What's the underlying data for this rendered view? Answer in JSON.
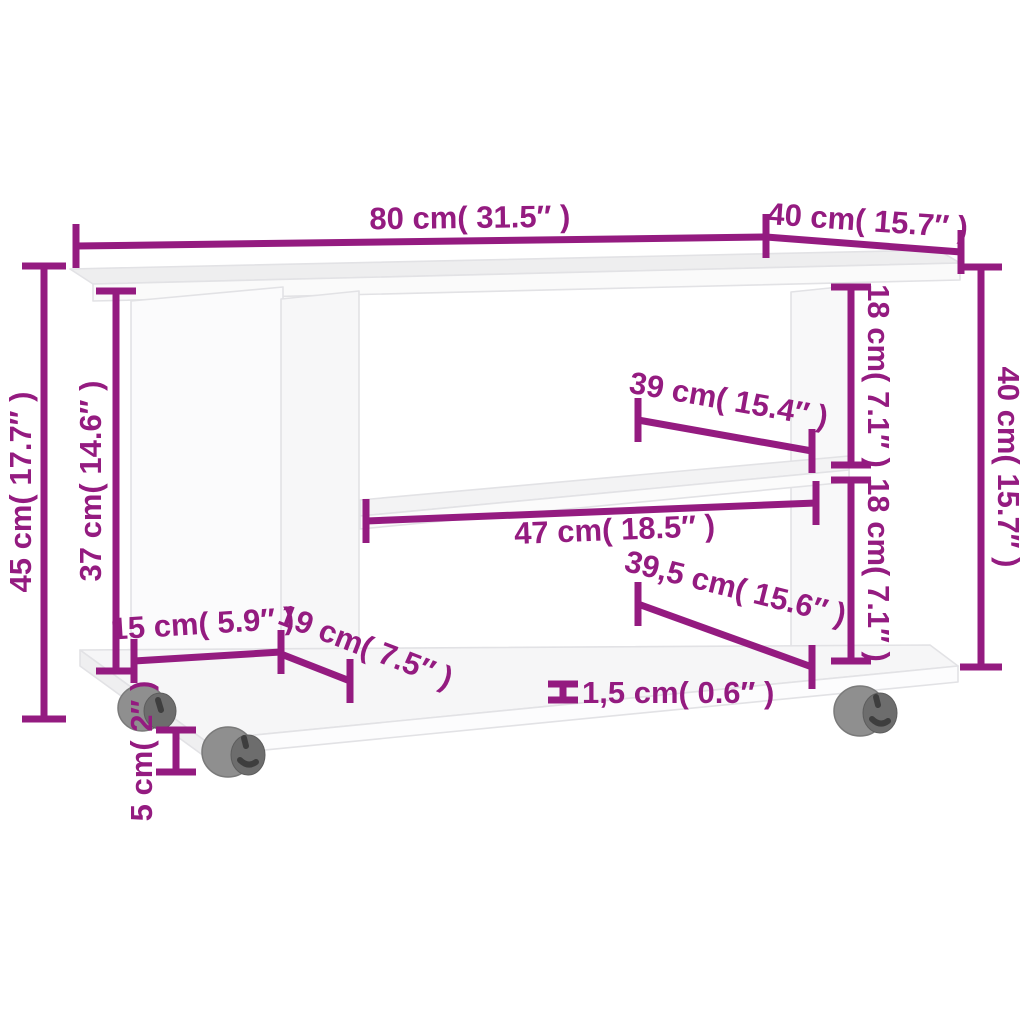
{
  "diagram": {
    "kind": "furniture-dimension-diagram",
    "background_color": "#ffffff",
    "accent_color": "#941b80",
    "panel_fill_color": "#fafafa",
    "panel_shade_color": "#eeeeef",
    "wheel_color": "#8f8f8f",
    "wheel_dark_color": "#6d6d6d"
  },
  "dims": [
    {
      "id": "top-width",
      "cm": 80,
      "inch": 31.5,
      "label": "80 cm( 31.5″ )"
    },
    {
      "id": "top-depth",
      "cm": 40,
      "inch": 15.7,
      "label": "40 cm( 15.7″ )"
    },
    {
      "id": "overall-height",
      "cm": 45,
      "inch": 17.7,
      "label": "45 cm( 17.7″ )"
    },
    {
      "id": "inner-height",
      "cm": 37,
      "inch": 14.6,
      "label": "37 cm( 14.6″ )"
    },
    {
      "id": "upper-right-height",
      "cm": 18,
      "inch": 7.1,
      "label": "18 cm( 7.1″ )"
    },
    {
      "id": "right-height",
      "cm": 40,
      "inch": 15.7,
      "label": "40 cm( 15.7″ )"
    },
    {
      "id": "upper-shelf-width",
      "cm": 39,
      "inch": 15.4,
      "label": "39 cm( 15.4″ )"
    },
    {
      "id": "middle-span",
      "cm": 47,
      "inch": 18.5,
      "label": "47 cm( 18.5″ )"
    },
    {
      "id": "lower-right-height",
      "cm": 18,
      "inch": 7.1,
      "label": "18 cm( 7.1″ )"
    },
    {
      "id": "lower-shelf-width",
      "cm": 39.5,
      "inch": 15.6,
      "label": "39,5 cm( 15.6″ )"
    },
    {
      "id": "left-offset",
      "cm": 15,
      "inch": 5.9,
      "label": "15 cm( 5.9″ )"
    },
    {
      "id": "left-depth",
      "cm": 19,
      "inch": 7.5,
      "label": "19 cm( 7.5″ )"
    },
    {
      "id": "board-thickness",
      "cm": 1.5,
      "inch": 0.6,
      "label": "1,5 cm( 0.6″ )"
    },
    {
      "id": "caster-height",
      "cm": 5,
      "inch": 2,
      "label": "5 cm( 2″ )"
    }
  ]
}
